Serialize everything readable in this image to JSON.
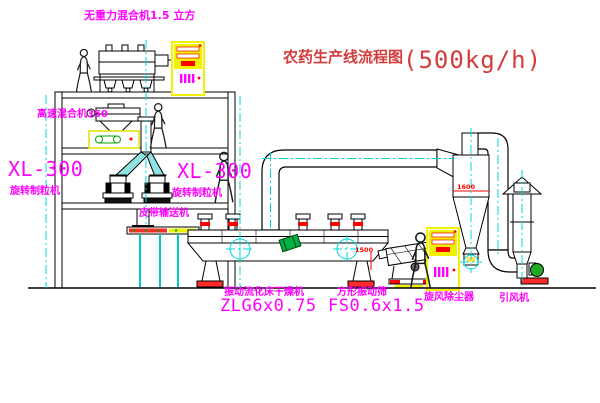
{
  "title": {
    "name": "农药生产线流程图",
    "capacity": "(500kg/h)"
  },
  "labels": {
    "gravity_mixer": "无重力混合机1.5 立方",
    "high_speed_mixer": "高速混合机350",
    "xl300_left": "XL-300",
    "granulator_left": "旋转制粒机",
    "xl300_right": "XL-300",
    "granulator_right": "旋转制粒机",
    "belt_conveyor": "皮带输送机",
    "dryer_name": "振动流化床干燥机",
    "dryer_model": "ZLG6x0.75",
    "screen_name": "方形振动筛",
    "screen_model": "FS0.6x1.5",
    "cyclone": "旋风除尘器",
    "fan": "引风机"
  },
  "dimensions": {
    "cyclone_width": "1600",
    "screen_offset": "1500"
  },
  "colors": {
    "label": "#ff00ff",
    "title": "#d43c3c",
    "centerline": "#00d8d8",
    "cabinet": "#f2f200",
    "dimension": "#ff0000",
    "accent_green": "#00b347"
  }
}
